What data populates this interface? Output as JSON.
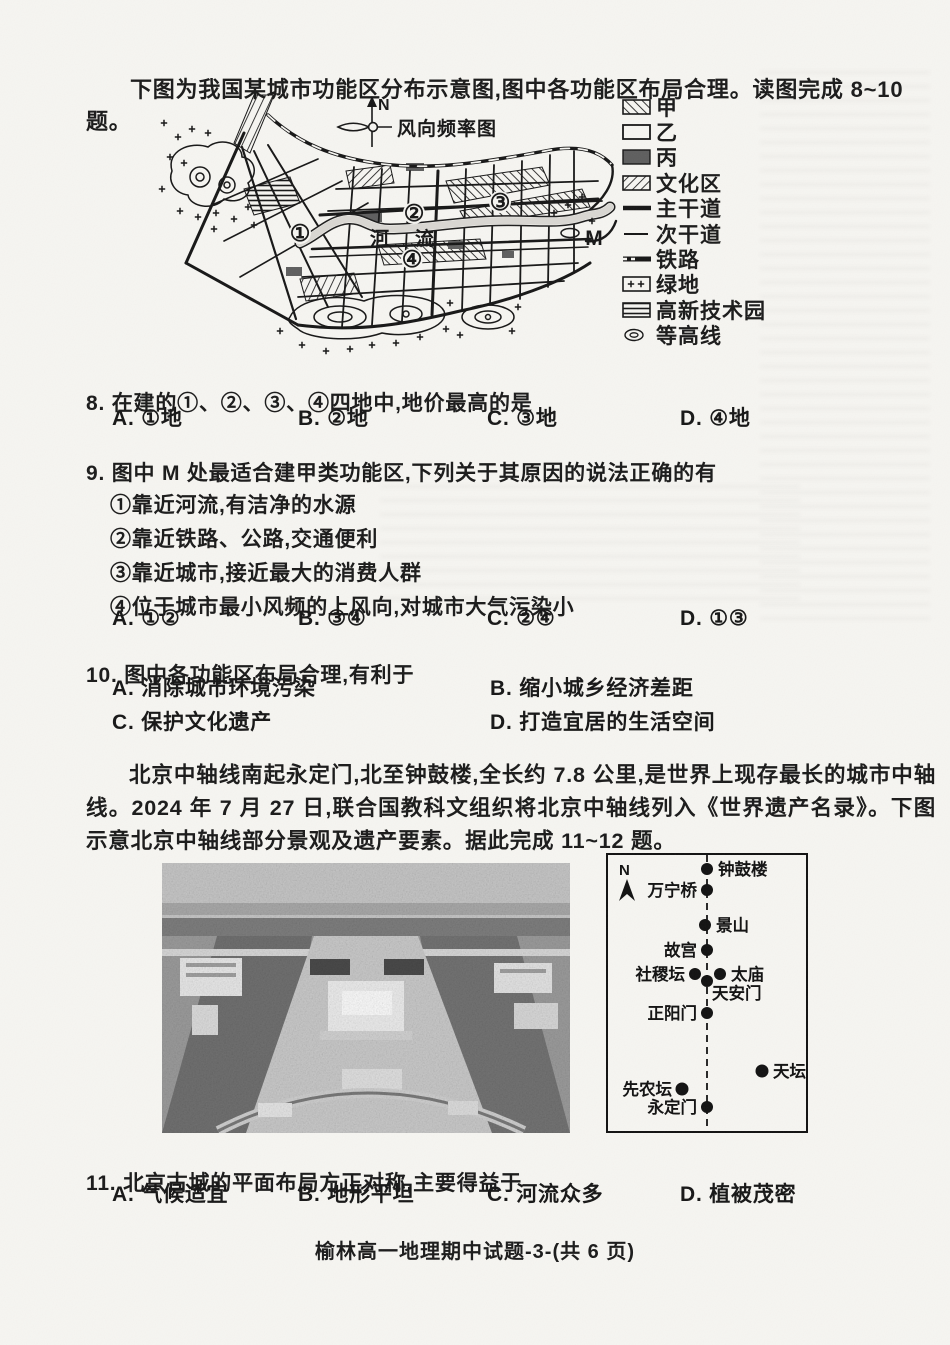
{
  "page": {
    "footer": "榆林高一地理期中试题-3-(共 6 页)"
  },
  "intro": "下图为我国某城市功能区分布示意图,图中各功能区布局合理。读图完成 8~10 题。",
  "city_map": {
    "north_label": "N",
    "wind_rose_label": "风向频率图",
    "river_label": "河流",
    "zones": {
      "z1": "①",
      "z2": "②",
      "z3": "③",
      "z4": "④"
    },
    "site_label": "M",
    "legend": [
      {
        "symbol": "forward-hatch-swatch",
        "label": "甲"
      },
      {
        "symbol": "empty-box-swatch",
        "label": "乙"
      },
      {
        "symbol": "dark-fill-swatch",
        "label": "丙"
      },
      {
        "symbol": "back-hatch-swatch",
        "label": "文化区"
      },
      {
        "symbol": "thick-line-swatch",
        "label": "主干道"
      },
      {
        "symbol": "thin-line-swatch",
        "label": "次干道"
      },
      {
        "symbol": "railway-line-swatch",
        "label": "铁路"
      },
      {
        "symbol": "plus-box-swatch",
        "label": "绿地"
      },
      {
        "symbol": "striped-box-swatch",
        "label": "高新技术园"
      },
      {
        "symbol": "contour-oval-swatch",
        "label": "等高线"
      }
    ]
  },
  "questions": {
    "q8": {
      "stem": "8. 在建的①、②、③、④四地中,地价最高的是",
      "options": [
        "A. ①地",
        "B. ②地",
        "C. ③地",
        "D. ④地"
      ]
    },
    "q9": {
      "stem": "9. 图中 M 处最适合建甲类功能区,下列关于其原因的说法正确的有",
      "items": [
        "①靠近河流,有洁净的水源",
        "②靠近铁路、公路,交通便利",
        "③靠近城市,接近最大的消费人群",
        "④位于城市最小风频的上风向,对城市大气污染小"
      ],
      "options": [
        "A. ①②",
        "B. ③④",
        "C. ②④",
        "D. ①③"
      ]
    },
    "q10": {
      "stem": "10. 图中各功能区布局合理,有利于",
      "options": [
        "A. 消除城市环境污染",
        "B. 缩小城乡经济差距",
        "C. 保护文化遗产",
        "D. 打造宜居的生活空间"
      ]
    },
    "q11": {
      "stem": "11. 北京古城的平面布局方正对称,主要得益于",
      "options": [
        "A. 气候适宜",
        "B. 地形平坦",
        "C. 河流众多",
        "D. 植被茂密"
      ]
    }
  },
  "passage": "北京中轴线南起永定门,北至钟鼓楼,全长约 7.8 公里,是世界上现存最长的城市中轴线。2024 年 7 月 27 日,联合国教科文组织将北京中轴线列入《世界遗产名录》。下图示意北京中轴线部分景观及遗产要素。据此完成 11~12 题。",
  "axis_diagram": {
    "north_label": "N",
    "landmarks": [
      {
        "name": "钟鼓楼"
      },
      {
        "name": "万宁桥"
      },
      {
        "name": "景山"
      },
      {
        "name": "故宫"
      },
      {
        "name": "社稷坛"
      },
      {
        "name": "太庙"
      },
      {
        "name": "天安门"
      },
      {
        "name": "正阳门"
      },
      {
        "name": "天坛"
      },
      {
        "name": "先农坛"
      },
      {
        "name": "永定门"
      }
    ]
  }
}
